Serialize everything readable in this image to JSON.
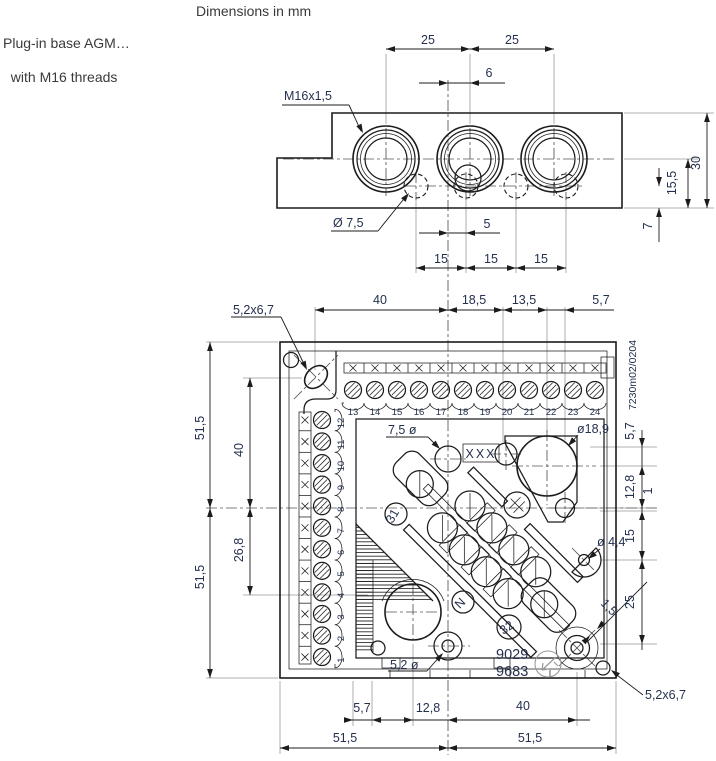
{
  "page": {
    "units_note": "Dimensions in mm",
    "product_line1": "Plug-in base AGM…",
    "product_line2": "with M16 threads"
  },
  "colors": {
    "line": "#1c1c1c",
    "extension": "#999999",
    "centerline": "#555555",
    "dim_text": "#24304e",
    "header_text": "#3a3a3a",
    "stamp": "#9a9a9a",
    "background": "#ffffff"
  },
  "top_view": {
    "thread_label": "M16x1,5",
    "hole_label": "Ø 7,5",
    "dim_pitch": [
      "25",
      "25"
    ],
    "dim_offset": "6",
    "dim_hole_offset": "5",
    "dim_hole_pitch": [
      "15",
      "15",
      "15"
    ],
    "dim_height": "30",
    "dim_center_height": "15,5",
    "dim_hole_row": "7"
  },
  "bottom_view": {
    "doc_number": "7230m02/0204",
    "slot_label_top": "5,2x6,7",
    "slot_label_bottom": "5,2x6,7",
    "hole_75_label": "7,5 ø",
    "hole_189_label": "ø18,9",
    "hole_44_label": "ø 4,4",
    "hole_52_label": "5,2 ø",
    "gap_label": "1,5",
    "marking": "XXX",
    "code_lines": [
      "9029",
      "9683"
    ],
    "terminal_31": "31",
    "terminal_32": "32",
    "terminal_n": "N",
    "terminals_top": [
      "13",
      "14",
      "15",
      "16",
      "17",
      "18",
      "19",
      "20",
      "21",
      "22",
      "23",
      "24"
    ],
    "terminals_left": [
      "12",
      "11",
      "10",
      "9",
      "8",
      "7",
      "6",
      "5",
      "4",
      "3",
      "2",
      "1"
    ],
    "dim_top_row": [
      "40",
      "18,5",
      "13,5",
      "5,7"
    ],
    "dim_left_outer": [
      "51,5",
      "51,5"
    ],
    "dim_left_inner": [
      "40",
      "26,8"
    ],
    "dim_right": [
      "5,7",
      "12,8",
      "1",
      "15",
      "25"
    ],
    "dim_bottom_row": [
      "5,7",
      "12,8",
      "40"
    ],
    "dim_bottom_outer": [
      "51,5",
      "51,5"
    ]
  }
}
